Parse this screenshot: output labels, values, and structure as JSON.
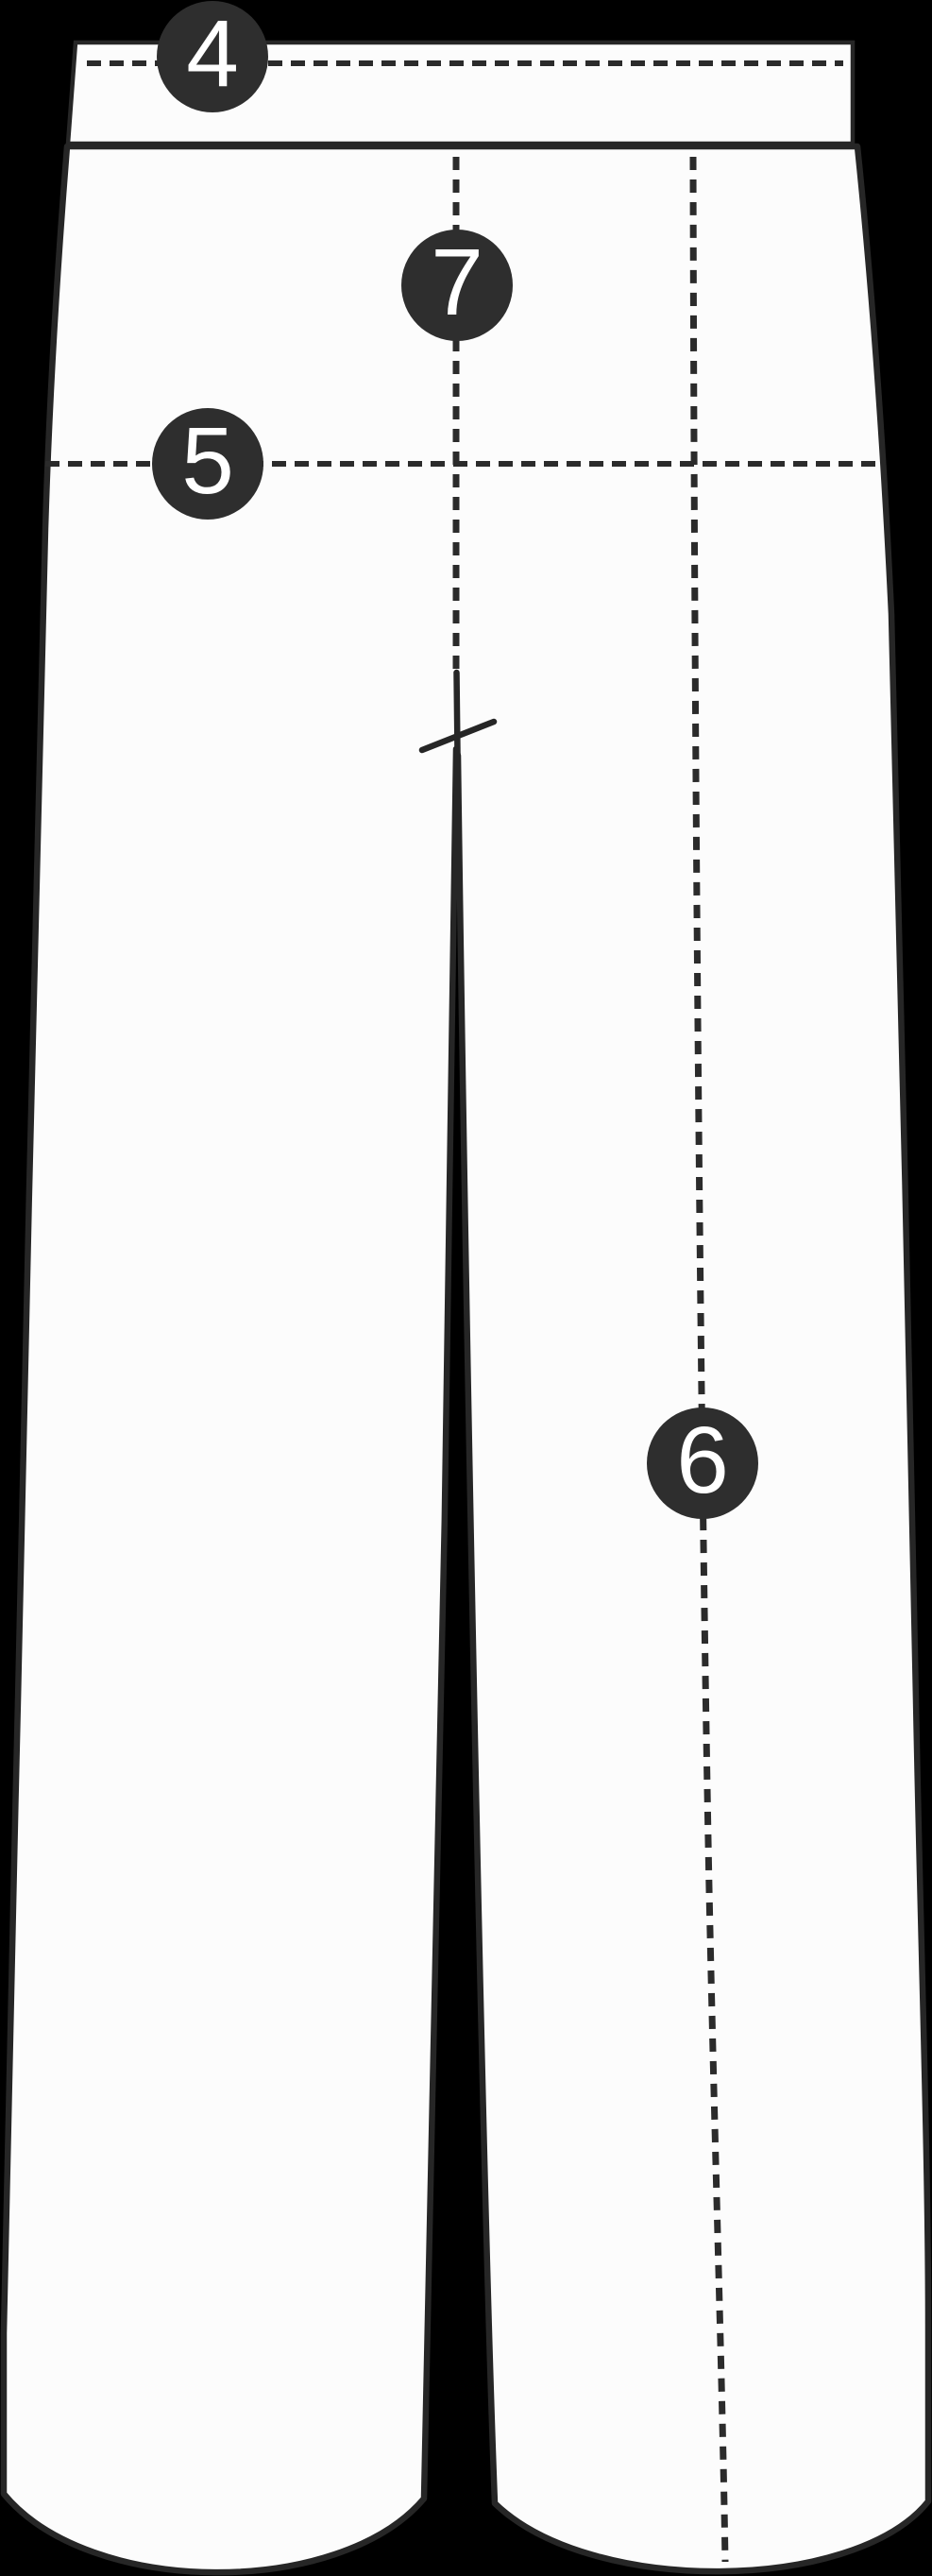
{
  "markers": [
    {
      "label": "4"
    },
    {
      "label": "5"
    },
    {
      "label": "6"
    },
    {
      "label": "7"
    }
  ],
  "colors": {
    "background": "#000000",
    "garment_fill": "#fcfcfc",
    "outline": "#262626",
    "dashed_line": "#2b2b2b",
    "marker_background": "#2e2e2e",
    "marker_text": "#ffffff"
  }
}
